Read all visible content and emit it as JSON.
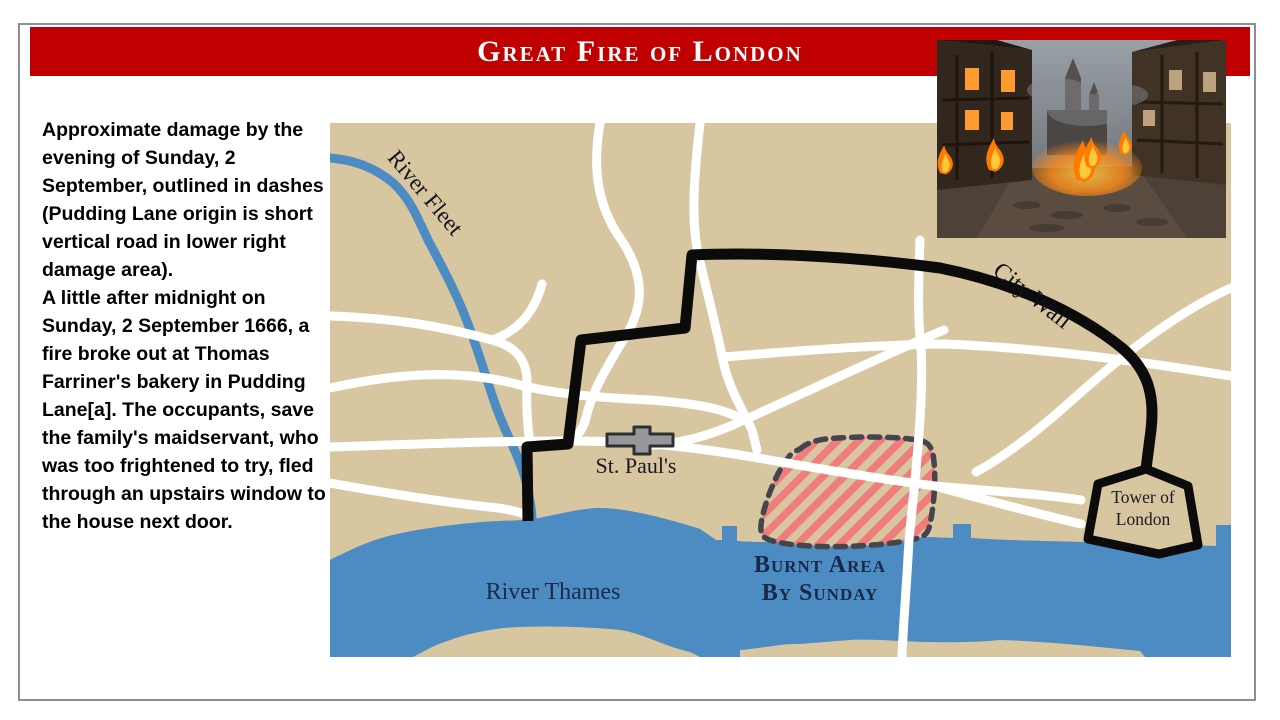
{
  "slide": {
    "title": "Great Fire of London"
  },
  "left_text": {
    "paragraph1": "Approximate damage by the evening of Sunday, 2 September, outlined in dashes (Pudding Lane origin is short vertical road in lower right damage area).",
    "paragraph2": "A little after midnight on Sunday, 2 September 1666, a fire broke out at Thomas Farriner's bakery in Pudding Lane[a]. The occupants, save the family's maidservant, who was too frightened to try, fled through an upstairs window to the house next door."
  },
  "map": {
    "labels": {
      "river_fleet": "River Fleet",
      "city_wall": "City Wall",
      "st_pauls": "St. Paul's",
      "river_thames": "River Thames",
      "burnt_area_line1": "Burnt Area",
      "burnt_area_line2": "By Sunday",
      "tower_line1": "Tower of",
      "tower_line2": "London"
    },
    "legend_meaning": {
      "dashed_outline": "Approximate damage by evening of Sunday, 2 September"
    },
    "colors": {
      "land": "#D8C6A1",
      "water": "#4C8CC2",
      "road": "#FFFFFF",
      "wall": "#0B0B0B",
      "burnt_stripe": "#F07C7C",
      "burnt_outline": "#45454D",
      "label_navy": "#1C2B4D"
    }
  },
  "theme": {
    "header_red": "#C00000",
    "border_gray": "#8D8D96",
    "title_color": "#FFFFFF",
    "body_text_color": "#000000"
  },
  "photo": {
    "description": "Burning medieval street scene"
  }
}
